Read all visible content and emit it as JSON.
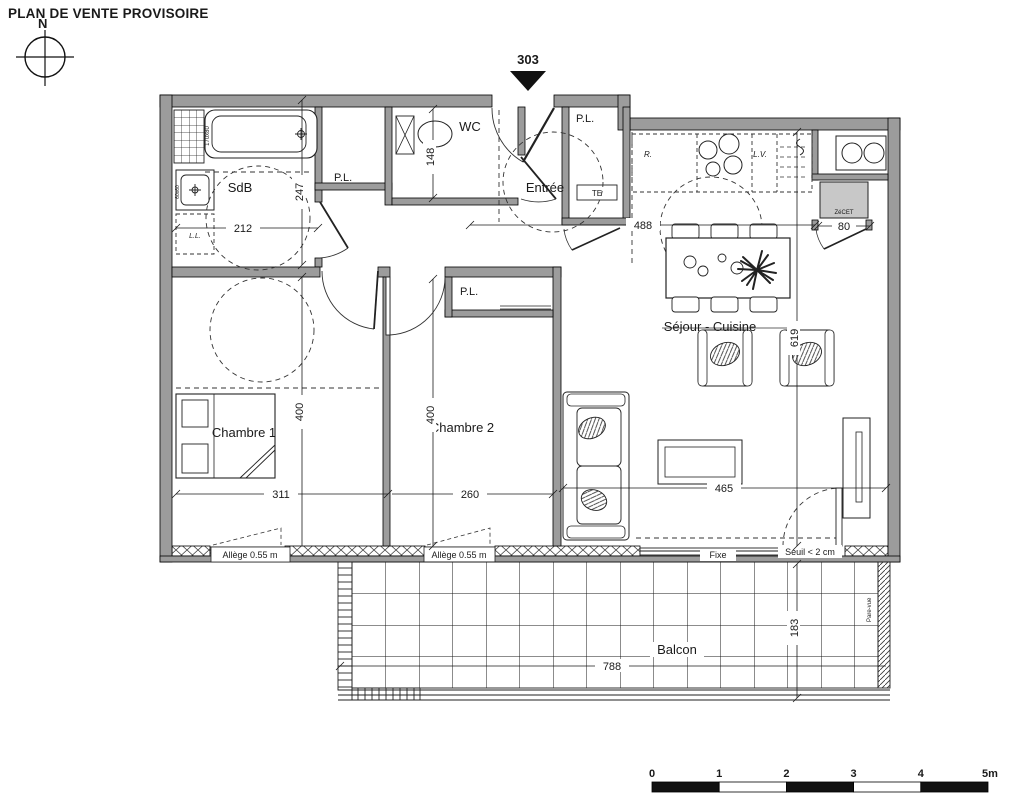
{
  "doc": {
    "title": "PLAN DE VENTE PROVISOIRE"
  },
  "compass": {
    "north": "N"
  },
  "lot": {
    "number": "303"
  },
  "rooms": {
    "sdb": "SdB",
    "wc": "WC",
    "entree": "Entrée",
    "sejour_cuisine": "Séjour - Cuisine",
    "chambre1": "Chambre 1",
    "chambre2": "Chambre 2",
    "balcon": "Balcon"
  },
  "closets": {
    "pl_sdb": "P.L.",
    "pl_entree": "P.L.",
    "pl_chambre2": "P.L.",
    "te": "TE"
  },
  "appliances": {
    "lave_linge": "L.L.",
    "refrigerateur": "R.",
    "lave_vaisselle": "L.V.",
    "cet": "ZéCET",
    "tub_size": "170x80",
    "sink_size": "60x60"
  },
  "dimensions": {
    "sdb_width": "212",
    "sdb_height": "247",
    "wc_height": "148",
    "kitchen_width": "488",
    "cet_width": "80",
    "sejour_height": "619",
    "chambre1_height": "400",
    "chambre2_height": "400",
    "chambre1_width": "311",
    "chambre2_width": "260",
    "sejour_width": "465",
    "balcon_width": "788",
    "balcon_depth": "183"
  },
  "windows": {
    "allege1": "Allège 0.55 m",
    "allege2": "Allège 0.55 m",
    "fixe": "Fixe",
    "seuil": "Seuil < 2 cm",
    "pare_vue": "Pare-vue"
  },
  "scale_bar": {
    "ticks": [
      "0",
      "1",
      "2",
      "3",
      "4",
      "5m"
    ]
  }
}
